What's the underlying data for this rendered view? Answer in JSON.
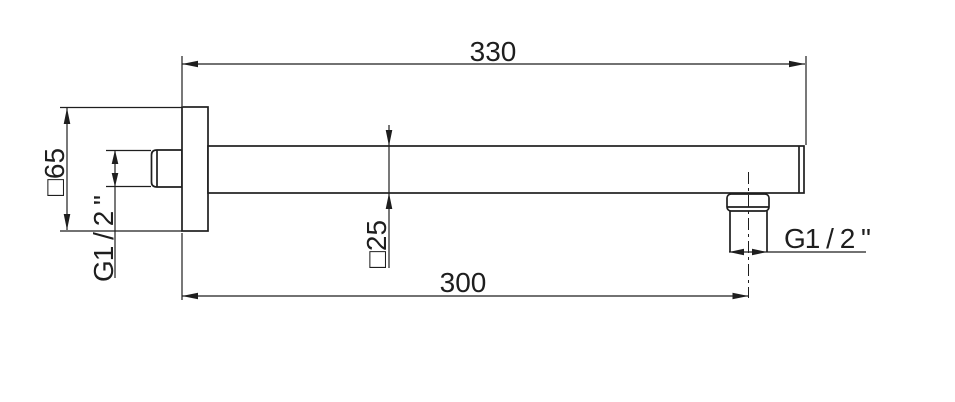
{
  "drawing": {
    "type": "technical-dimension-drawing",
    "subject": "wall-mounted square shower arm, side view",
    "background_color": "#ffffff",
    "line_color": "#1e1e1e",
    "labels": {
      "overall_length": "330",
      "projection_length": "300",
      "wall_plate_size": "□65",
      "arm_profile_size": "□25",
      "inlet_thread": "G1 / 2 \"",
      "outlet_thread": "G1 / 2 \""
    }
  }
}
